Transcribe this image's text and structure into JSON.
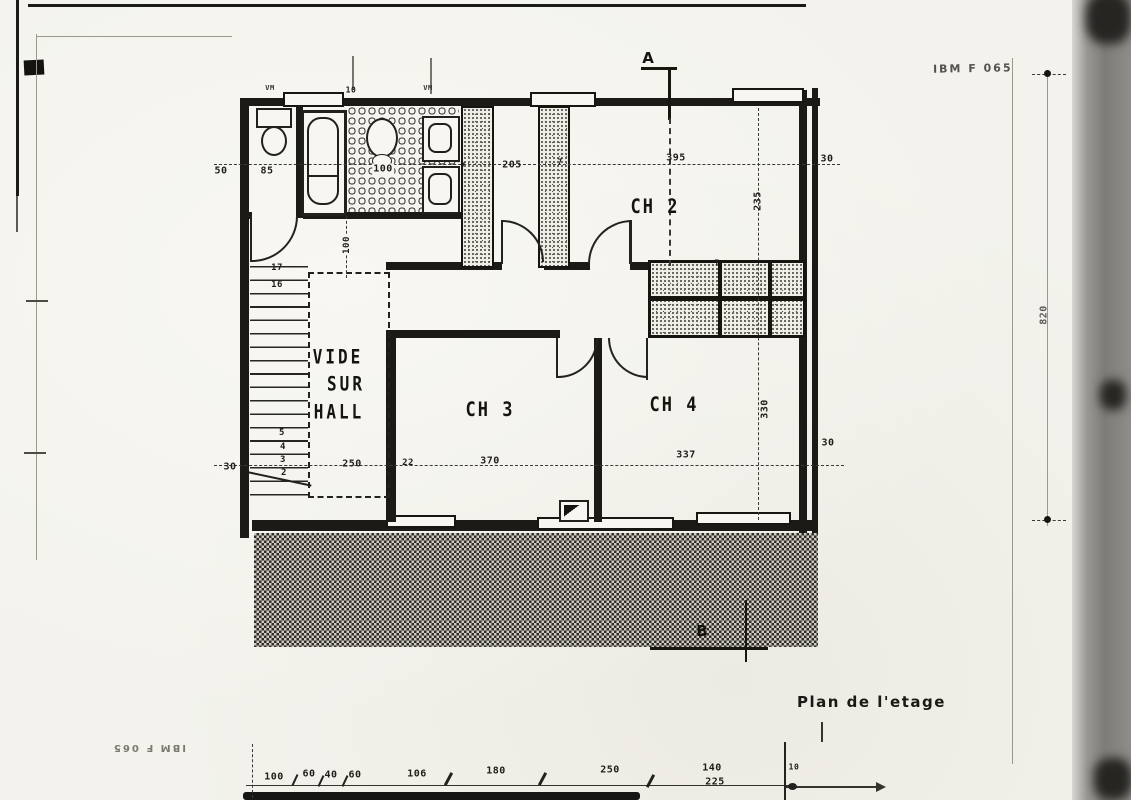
{
  "document": {
    "title": "Plan de l'etage",
    "stamp_top_right": "IBM F 065",
    "stamp_bottom_left": "IBM F 065"
  },
  "rooms": {
    "ch2": "CH 2",
    "ch3": "CH 3",
    "ch4": "CH 4",
    "vide": {
      "line1": "VIDE",
      "line2": "SUR",
      "line3": "HALL"
    }
  },
  "sections": {
    "a": "A",
    "b": "B"
  },
  "dim_labels": [
    {
      "t": "50",
      "x": 221,
      "y": 171
    },
    {
      "t": "85",
      "x": 267,
      "y": 171
    },
    {
      "t": "100",
      "x": 383,
      "y": 169,
      "chip": true
    },
    {
      "t": "205",
      "x": 512,
      "y": 165
    },
    {
      "t": "7",
      "x": 463,
      "y": 166,
      "s": 8
    },
    {
      "t": "7",
      "x": 560,
      "y": 162,
      "s": 8
    },
    {
      "t": "395",
      "x": 676,
      "y": 158
    },
    {
      "t": "30",
      "x": 827,
      "y": 159
    },
    {
      "t": "235",
      "x": 758,
      "y": 201,
      "r": -90
    },
    {
      "t": "330",
      "x": 765,
      "y": 409,
      "r": -90
    },
    {
      "t": "7",
      "x": 717,
      "y": 263,
      "s": 8
    },
    {
      "t": "100",
      "x": 347,
      "y": 245,
      "r": -90,
      "s": 9,
      "chip": true
    },
    {
      "t": "30",
      "x": 230,
      "y": 467
    },
    {
      "t": "250",
      "x": 352,
      "y": 464
    },
    {
      "t": "22",
      "x": 408,
      "y": 463,
      "s": 9
    },
    {
      "t": "370",
      "x": 490,
      "y": 461
    },
    {
      "t": "337",
      "x": 686,
      "y": 455
    },
    {
      "t": "30",
      "x": 828,
      "y": 443
    },
    {
      "t": "820",
      "x": 1044,
      "y": 315,
      "r": -90,
      "c": "#5b5a55"
    },
    {
      "t": "10",
      "x": 351,
      "y": 90,
      "s": 8
    },
    {
      "t": "VM",
      "x": 270,
      "y": 88,
      "s": 7,
      "c": "#33322e"
    },
    {
      "t": "VM",
      "x": 428,
      "y": 88,
      "s": 7,
      "c": "#33322e"
    },
    {
      "t": "17",
      "x": 277,
      "y": 268,
      "s": 9
    },
    {
      "t": "16",
      "x": 277,
      "y": 285,
      "s": 9
    },
    {
      "t": "5",
      "x": 282,
      "y": 433,
      "s": 9
    },
    {
      "t": "4",
      "x": 283,
      "y": 447,
      "s": 9
    },
    {
      "t": "3",
      "x": 283,
      "y": 460,
      "s": 9
    },
    {
      "t": "2",
      "x": 284,
      "y": 473,
      "s": 9
    },
    {
      "t": "100",
      "x": 274,
      "y": 777
    },
    {
      "t": "60",
      "x": 309,
      "y": 774
    },
    {
      "t": "40",
      "x": 331,
      "y": 775
    },
    {
      "t": "60",
      "x": 355,
      "y": 775
    },
    {
      "t": "106",
      "x": 417,
      "y": 774
    },
    {
      "t": "180",
      "x": 496,
      "y": 771
    },
    {
      "t": "250",
      "x": 610,
      "y": 770
    },
    {
      "t": "140",
      "x": 712,
      "y": 768
    },
    {
      "t": "225",
      "x": 715,
      "y": 782
    },
    {
      "t": "10",
      "x": 794,
      "y": 767,
      "s": 8
    }
  ]
}
